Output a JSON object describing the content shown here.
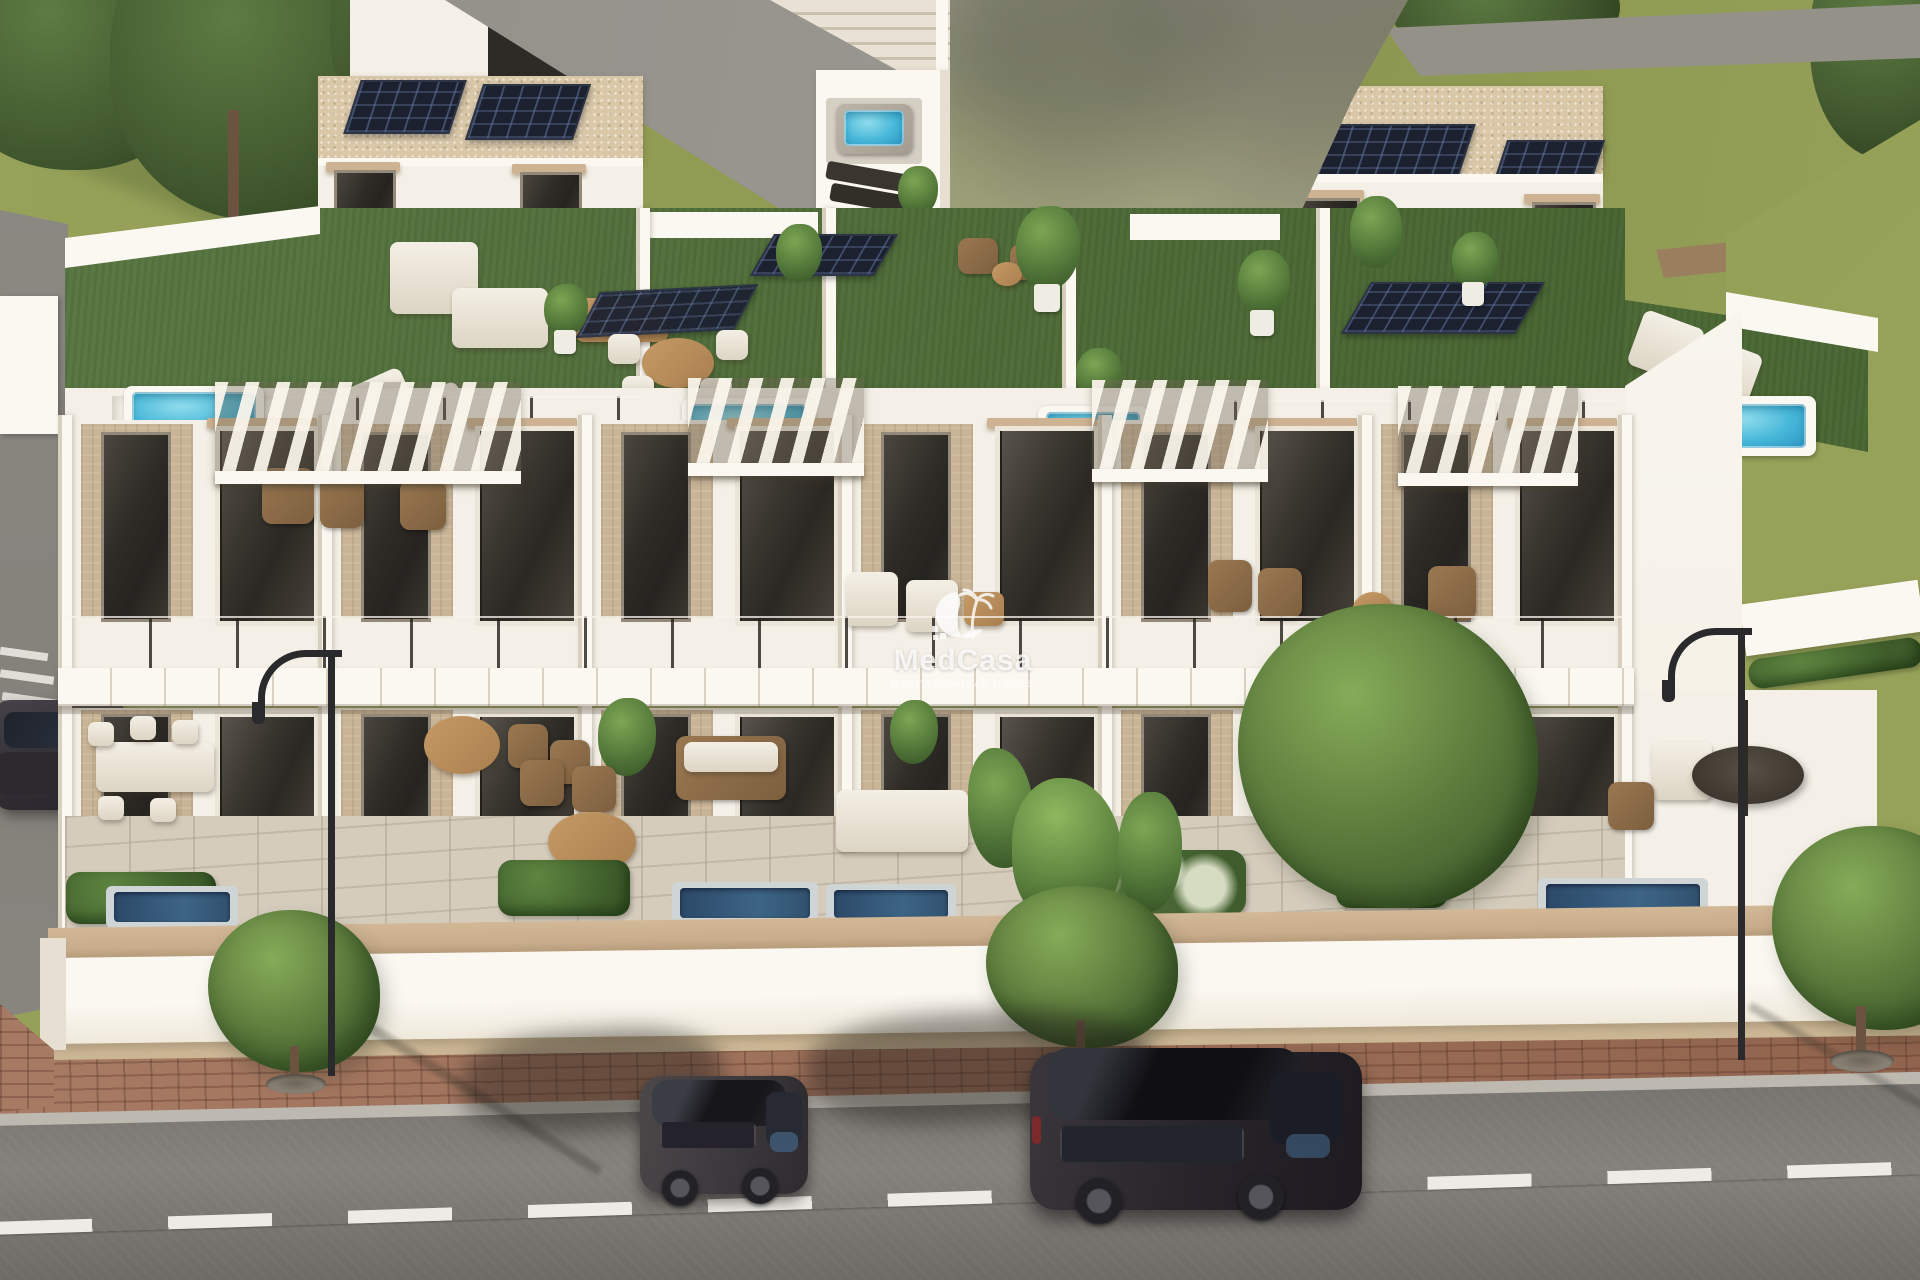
{
  "image": {
    "kind": "3d-architectural-render",
    "width_px": 1920,
    "height_px": 1280
  },
  "watermark": {
    "brand": "MedCasa",
    "tagline": "MEDITERRANEAN HOMES",
    "logo": "palm-beach-icon"
  },
  "scene": {
    "building": {
      "units": 6,
      "floors": 2,
      "rooftop_pools": 4,
      "ground_terrace_pools": 4,
      "solar_arrays": 7,
      "facade_finishes": [
        "white-render",
        "travertine-beige-panels",
        "glass-balustrades",
        "wood-pergolas"
      ]
    },
    "street": {
      "parked_cars": 3,
      "street_trees": 4,
      "street_lamps": 2,
      "lane_marking": "dashed-white",
      "sidewalk": "red-brick-pavers"
    }
  },
  "colors": {
    "grass": "#97a259",
    "grass2": "#8b9750",
    "tree-dark": "#42592f",
    "white-wall": "#f4f0e7",
    "white-bright": "#fbf8f2",
    "white-shade": "#e7e0d2",
    "white-shadow": "#d8d0bf",
    "gravel": "#d9c7a8",
    "solar": "#1c2130",
    "turf": "#507038",
    "beige": "#c9b496",
    "lintel": "#cdb391",
    "pool-blue": "#45b6d8",
    "wall-coping": "#c8ad8c",
    "paver": "#cbb694",
    "brick": "#a06f56",
    "road": "#7f7c77",
    "curb": "#bdb8b0",
    "dash": "#edebe5",
    "path": "#8f8c86",
    "car-dark": "#39363a",
    "car-darker": "#232126",
    "wm": "rgba(255,255,255,0.80)"
  }
}
